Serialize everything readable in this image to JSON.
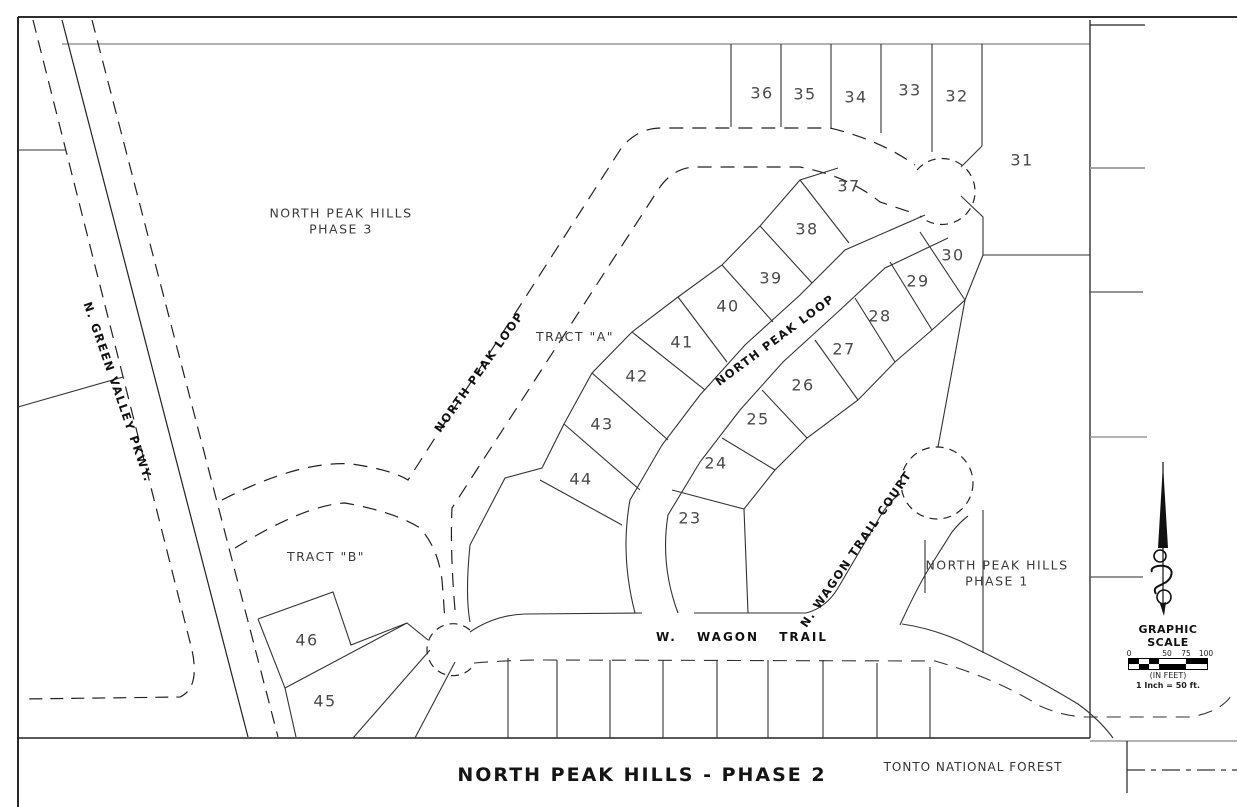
{
  "map": {
    "title": "NORTH PEAK HILLS - PHASE 2",
    "areas": {
      "phase3_line1": "NORTH PEAK HILLS",
      "phase3_line2": "PHASE 3",
      "phase1_line1": "NORTH PEAK HILLS",
      "phase1_line2": "PHASE 1",
      "tract_a": "TRACT \"A\"",
      "tract_b": "TRACT \"B\"",
      "tonto": "TONTO NATIONAL FOREST"
    },
    "streets": {
      "green_valley": "N. GREEN VALLEY PKWY.",
      "north_peak_loop_west": "NORTH PEAK LOOP",
      "north_peak_loop_main": "NORTH PEAK LOOP",
      "wagon_trail": "W. WAGON TRAIL",
      "wagon_trail_court": "N. WAGON TRAIL COURT"
    },
    "lots": [
      "23",
      "24",
      "25",
      "26",
      "27",
      "28",
      "29",
      "30",
      "31",
      "32",
      "33",
      "34",
      "35",
      "36",
      "37",
      "38",
      "39",
      "40",
      "41",
      "42",
      "43",
      "44",
      "45",
      "46"
    ],
    "scale": {
      "heading": "GRAPHIC SCALE",
      "ticks": [
        "0",
        "50",
        "75",
        "100"
      ],
      "unit_note": "(IN FEET)",
      "ratio_note": "1 Inch = 50 ft."
    },
    "icons": {
      "north_arrow": "ornate-north-arrow"
    }
  }
}
